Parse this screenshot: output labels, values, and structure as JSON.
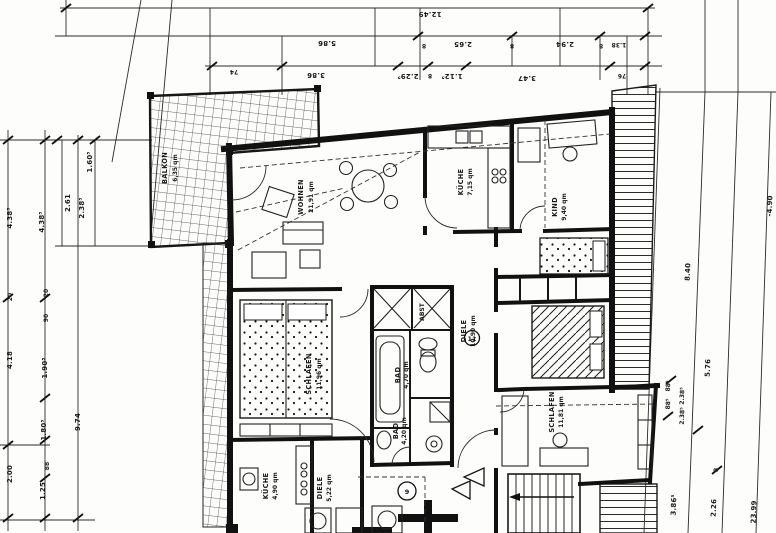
{
  "drawing": {
    "kind": "architectural floor plan (scanned blueprint, German labels)",
    "units_note": "qm = square meters"
  },
  "rooms": {
    "balkon": {
      "name": "BALKON",
      "area": "6,35 qm"
    },
    "wohnen": {
      "name": "WOHNEN",
      "area": "21,91 qm"
    },
    "kueche1": {
      "name": "KÜCHE",
      "area": "7,15 qm"
    },
    "kind": {
      "name": "KIND",
      "area": "9,40 qm"
    },
    "schlafen1": {
      "name": "SCHLAFEN",
      "area": "11,96 qm"
    },
    "abst": {
      "name": "ABST"
    },
    "bad1": {
      "name": "BAD",
      "area": "4,70 qm"
    },
    "diele1": {
      "name": "DIELE",
      "area": "10,90 qm"
    },
    "schlafen2": {
      "name": "SCHLAFEN",
      "area": "11,81 qm"
    },
    "bad2": {
      "name": "BAD",
      "area": "4,20 qm"
    },
    "kueche2": {
      "name": "KÜCHE",
      "area": "4,90 qm"
    },
    "diele2": {
      "name": "DIELE",
      "area": "5,22 qm"
    }
  },
  "markers": {
    "eleven": "11",
    "nine": "9"
  },
  "dims": {
    "top1": "12.49",
    "t586": "5.86",
    "t265": "2.65",
    "t294": "2.94",
    "t138": "1.38",
    "t74": "74",
    "t386": "3.86",
    "t2295": "2.29⁵",
    "t1125": "1.12⁵",
    "t347": "3.47",
    "t76": "76",
    "eight": "8",
    "l1605": "1.60⁵",
    "l261": "2.61",
    "l2385": "2.38⁵",
    "l4385": "4.38⁵",
    "l20": "20",
    "l90": "90",
    "l418": "4.18",
    "l1905": "1.90⁵",
    "l974": "9.74",
    "l1805": "1.80⁵",
    "l88": "88",
    "l200": "2.00",
    "l125": "1.25",
    "r490": "-4.90",
    "r840": "8.40",
    "r576": "5.76",
    "r885": "88⁵",
    "r2385": "2.38⁵",
    "r8": "8",
    "r3865": "3.86⁵",
    "r226": "2.26",
    "r2399": "23.99"
  }
}
